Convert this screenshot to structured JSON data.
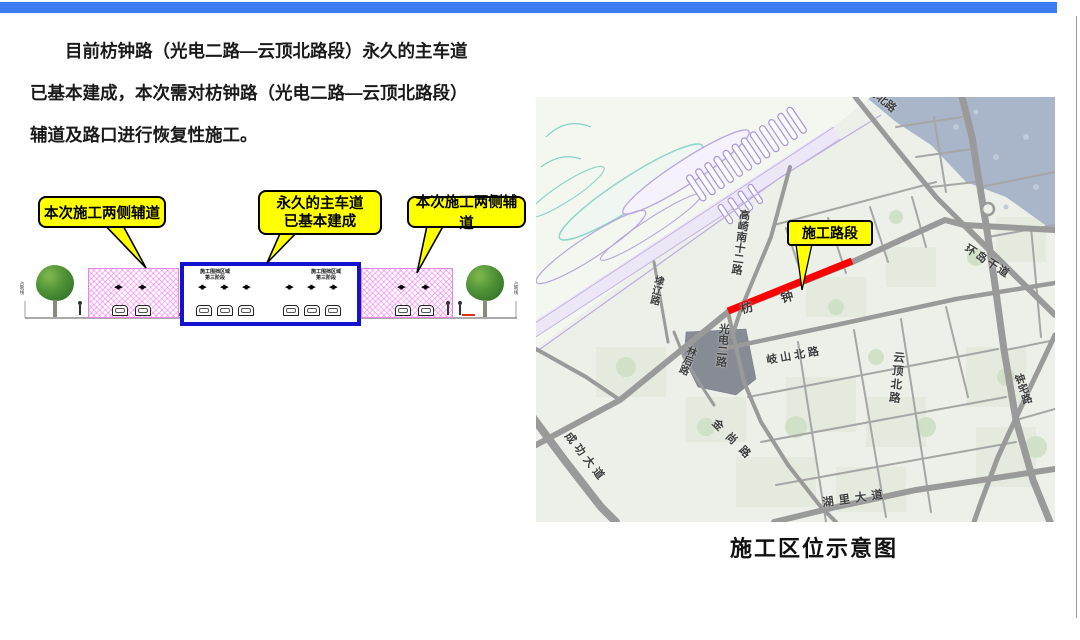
{
  "intro": {
    "lines": [
      "目前枋钟路（光电二路—云顶北路段）永久的主车道",
      "已基本建成，本次需对枋钟路（光电二路—云顶北路段）",
      "辅道及路口进行恢复性施工。"
    ]
  },
  "callouts": {
    "left": "本次施工两侧辅道",
    "center": [
      "永久的主车道",
      "已基本建成"
    ],
    "right": "本次施工两侧辅道"
  },
  "cross_section": {
    "boundary_label_left": "占地线",
    "boundary_label_right": "占地线",
    "zone_label_left": [
      "施工围挡区域",
      "第三阶段"
    ],
    "zone_label_right": [
      "施工围挡区域",
      "第三阶段"
    ]
  },
  "map": {
    "callout": "施工路段",
    "caption": "施工区位示意图",
    "labels": {
      "gaoqi": "高崎南十二路",
      "fangzhong": "枋 钟",
      "dailiao": "埭辽路",
      "guangdian": "光电二路",
      "linhou": "林后路",
      "qishan": "岐山北路",
      "yunding": "云顶北路",
      "jinshang": "金尚路",
      "chenggong": "成功大道",
      "hulidadao": "湖里大道",
      "huandao": "环岛干道",
      "zhongzhai": "钟宅路",
      "daobeilu": "岛北路"
    }
  },
  "colors": {
    "accent_bar": "#3b7cf2",
    "callout_yellow": "#ffff00",
    "construction_red": "#fe0000",
    "main_road_box_blue": "#1313cf",
    "side_road_pink": "#f864f8"
  }
}
